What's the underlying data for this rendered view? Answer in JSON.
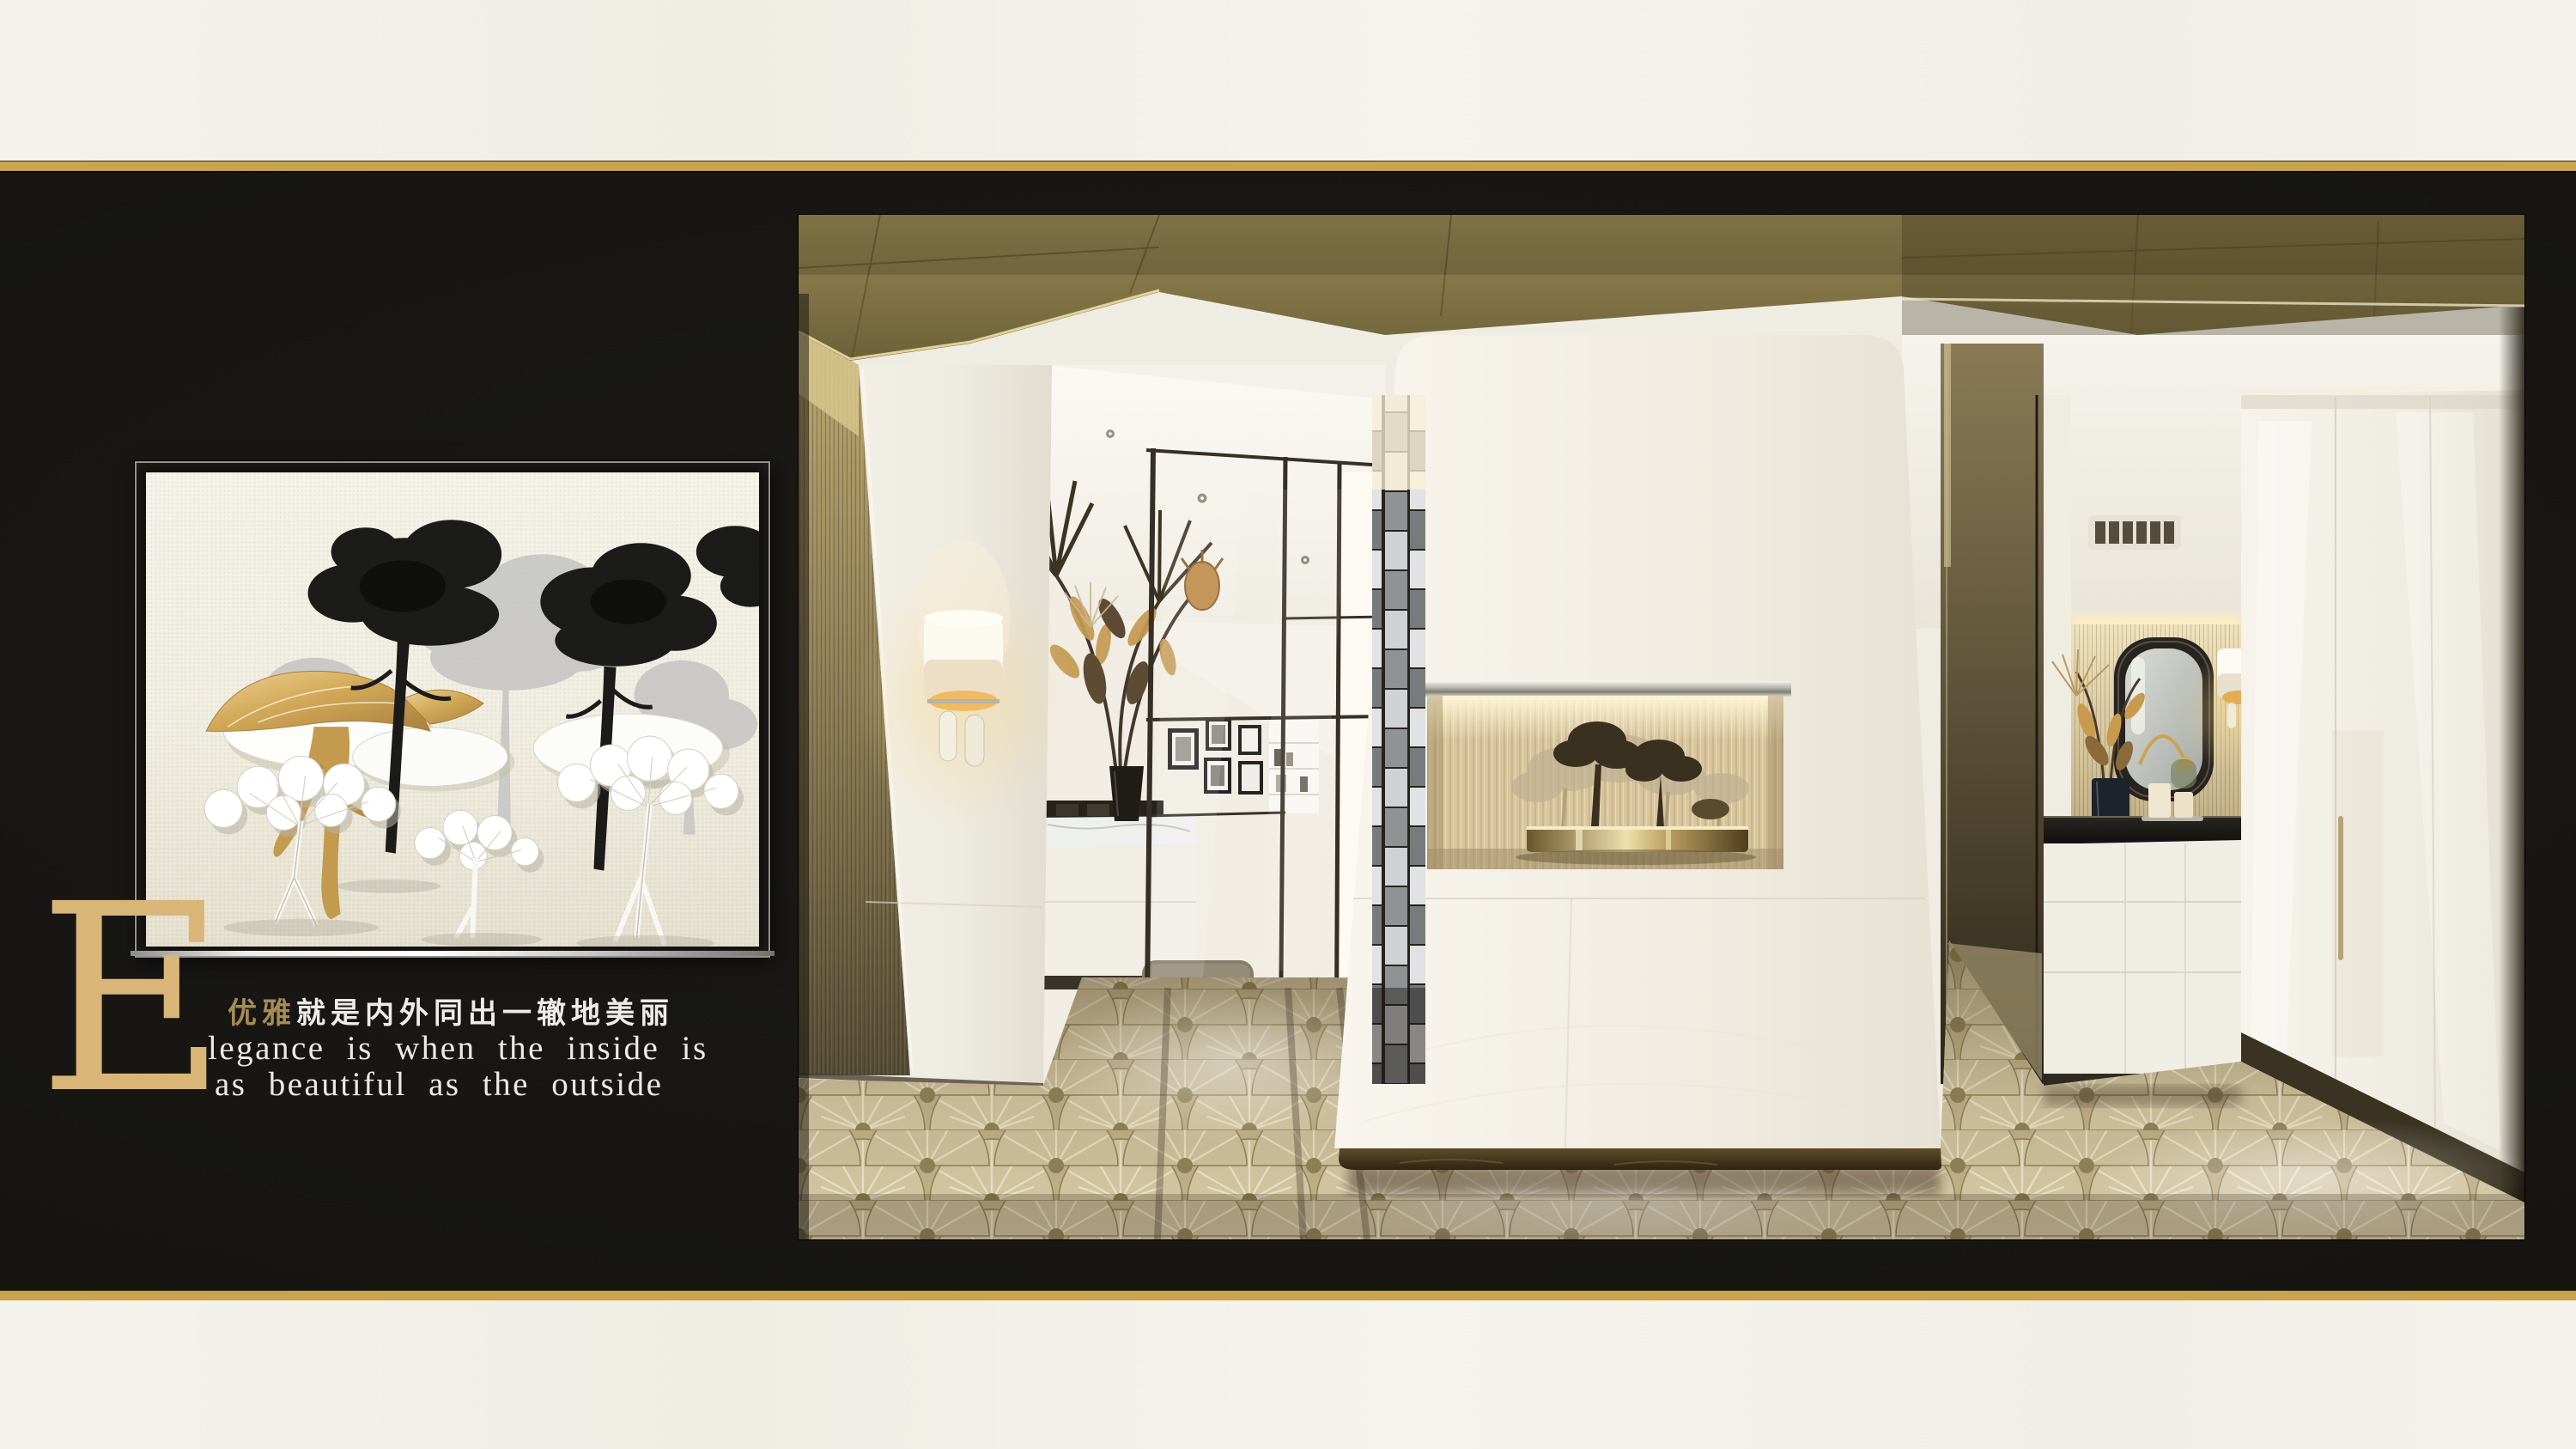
{
  "page": {
    "kind": "interior-design brand poster slide",
    "background": "#181714",
    "band_color": "#f3f1ea",
    "gold_divider": {
      "dark": "#7a5e26",
      "mid": "#c9a44c",
      "bright": "#f2dc96"
    }
  },
  "hero": {
    "drop_cap": "E",
    "headline_zh_highlight": "优雅",
    "headline_zh_rest": "就是内外同出一辙地美丽",
    "tagline_en": [
      "legance is when the inside is",
      "as beautiful as the outside"
    ],
    "colors": {
      "drop_cap_gold": "#d9b678",
      "zh_highlight_gold": "#a68c54",
      "text_white": "#edecea"
    }
  },
  "artwork": {
    "name": "paper-cut tree wall art",
    "palette": {
      "paper": "#f1eee3",
      "black_tree": "#1b1b1a",
      "gray_tree": "#c6c6c4",
      "white_tree": "#ffffff",
      "gold_tree": "#d3a958",
      "frame_silver": "#e6e6e4"
    }
  },
  "photo": {
    "name": "luxury showroom interior",
    "palette": {
      "wood_ceiling": "#857549",
      "warm_cove": "#f4dfa5",
      "silk_niche": "#d9c7a2",
      "bronze": "#8d7748",
      "floor_tan": "#c3b28a",
      "floor_cream": "#d7caa6",
      "gloss_white": "#f4f1e8",
      "grasscloth": "#9c8a5e",
      "marble_dark": "#211f1b"
    }
  }
}
